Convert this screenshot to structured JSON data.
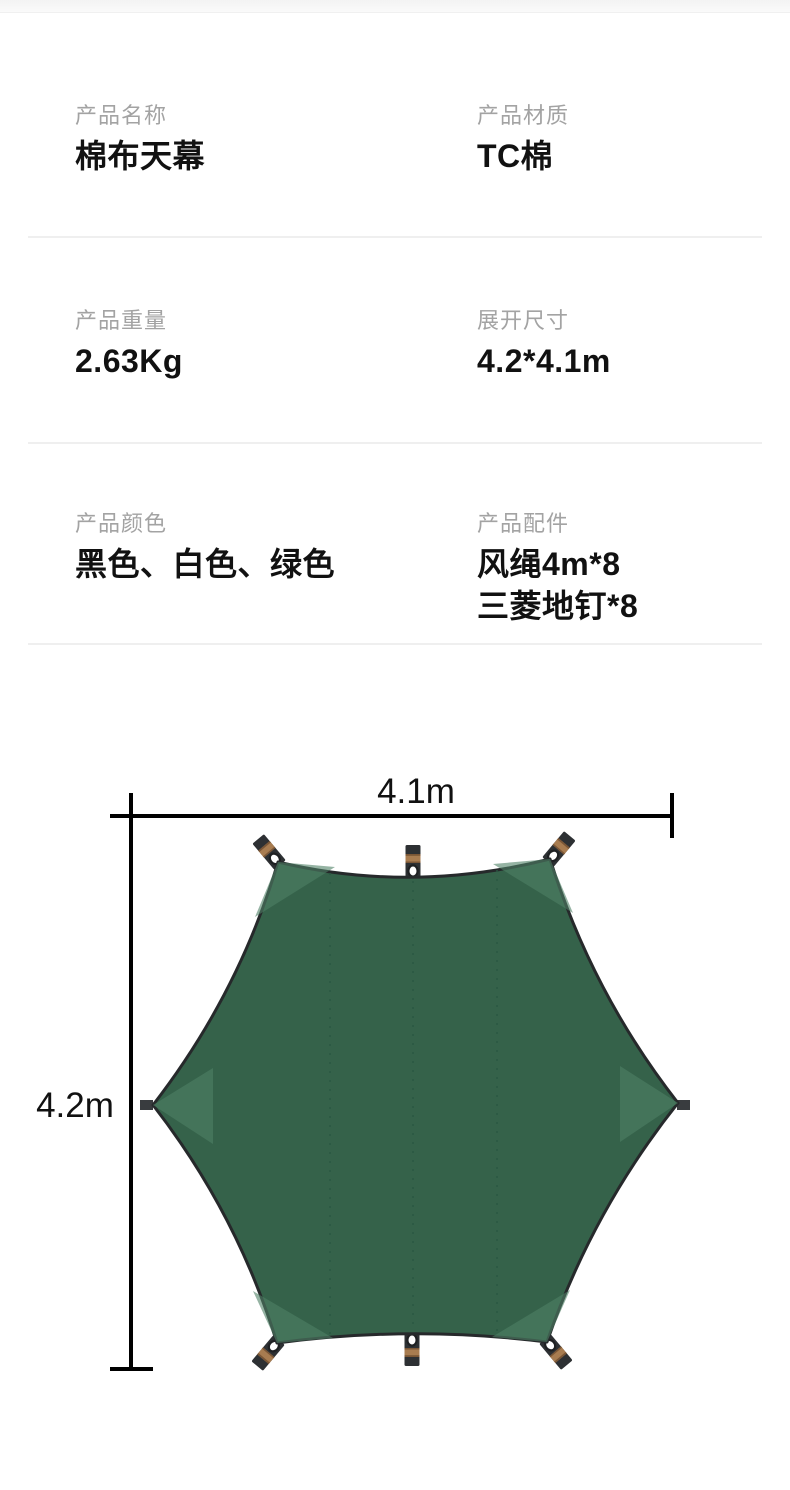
{
  "specs": [
    {
      "label": "产品名称",
      "value": "棉布天幕"
    },
    {
      "label": "产品材质",
      "value": "TC棉"
    },
    {
      "label": "产品重量",
      "value": "2.63Kg"
    },
    {
      "label": "展开尺寸",
      "value": "4.2*4.1m"
    },
    {
      "label": "产品颜色",
      "value": "黑色、白色、绿色"
    },
    {
      "label": "产品配件",
      "value_lines": [
        "风绳4m*8",
        "三菱地钉*8"
      ]
    }
  ],
  "diagram": {
    "width_label": "4.1m",
    "height_label": "4.2m",
    "colors": {
      "tarp_fill": "#35624a",
      "corner_patch": "#4f8065",
      "outline": "#26292b",
      "webbing": "#2d3033",
      "webbing_stripe": "#a87c50",
      "grommet": "#ffffff",
      "seam": "#2b5743",
      "dimension_line": "#000000"
    }
  }
}
